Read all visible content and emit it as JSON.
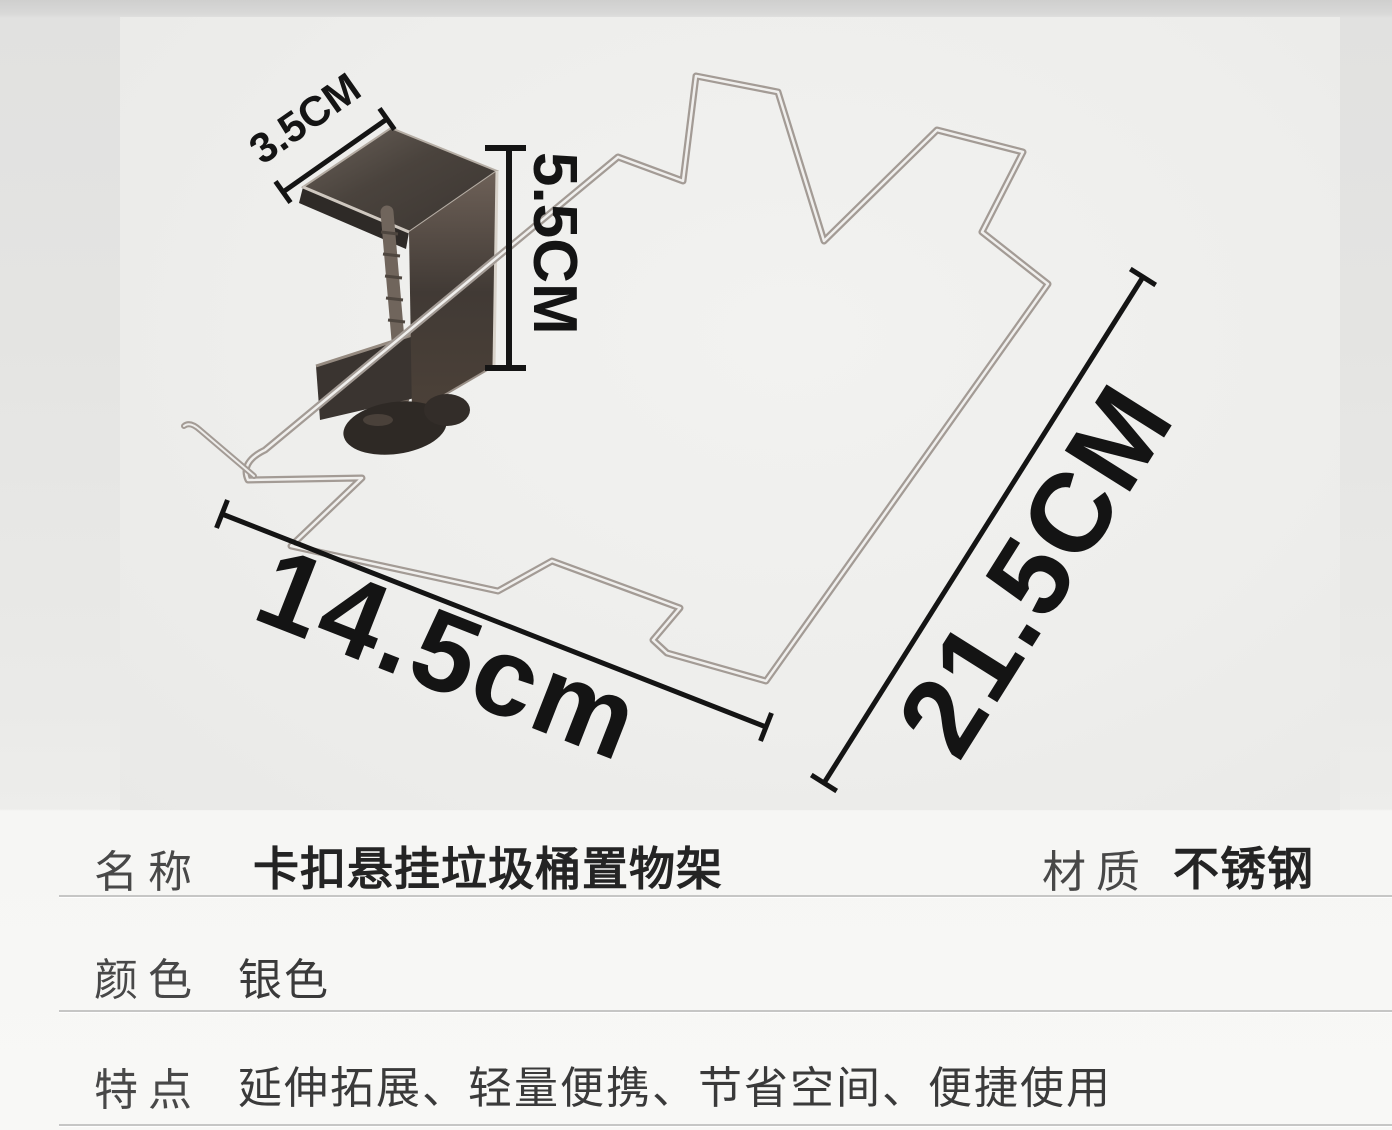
{
  "photo": {
    "annotations": {
      "clamp_width": "3.5CM",
      "clamp_depth": "5.5CM",
      "frame_width": "14.5cm",
      "frame_length": "21.5CM"
    }
  },
  "specs": {
    "row1": {
      "label": "名称",
      "value": "卡扣悬挂垃圾桶置物架",
      "label2": "材质",
      "value2": "不锈钢"
    },
    "row2": {
      "label": "颜色",
      "value": "银色"
    },
    "row3": {
      "label": "特点",
      "value": "延伸拓展、轻量便携、节省空间、便捷使用"
    }
  },
  "colors": {
    "annotation_ink": "#141414",
    "wire_outline": "#a39b95",
    "wire_highlight": "#f0efed",
    "clamp_metal_dark": "#3f3834",
    "panel_background": "#efefed",
    "page_background": "#e3e3e2",
    "table_background": "#f7f7f5",
    "divider": "#c6c6c5"
  }
}
